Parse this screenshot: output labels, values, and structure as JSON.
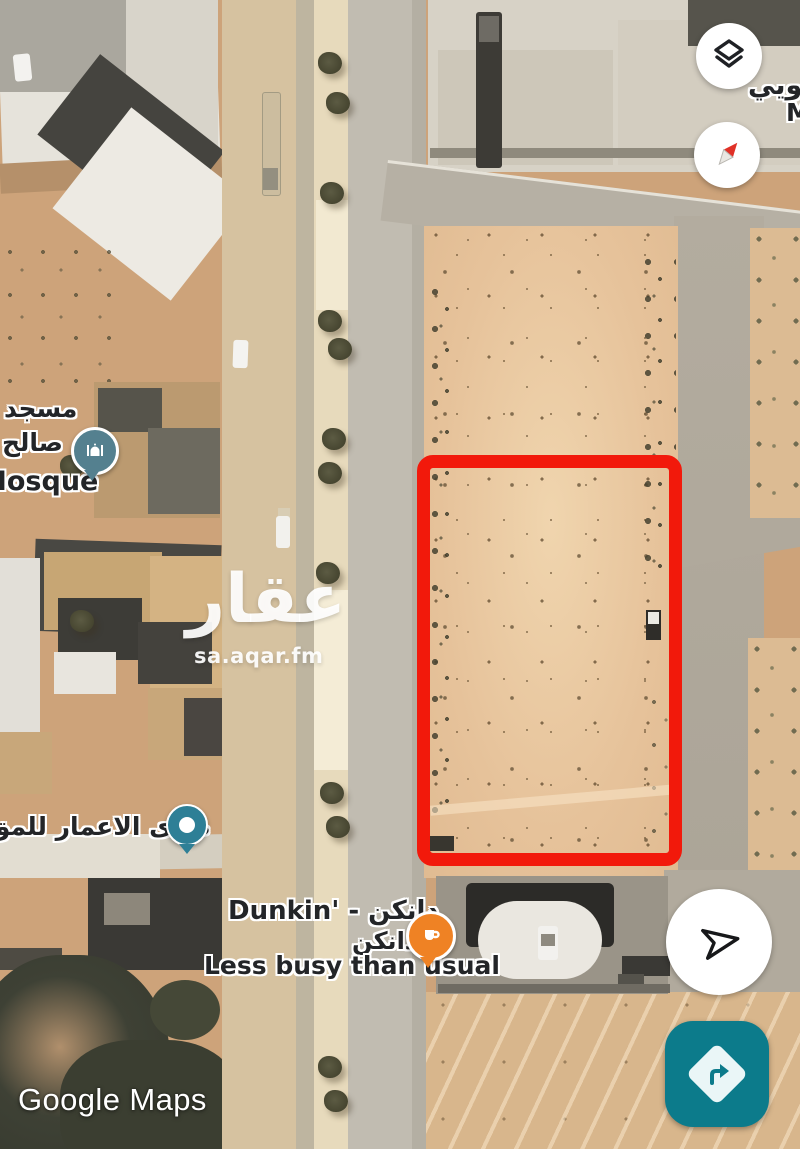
{
  "attribution": {
    "text": "Google Maps"
  },
  "watermark": {
    "logo": "عقار",
    "site": "sa.aqar.fm"
  },
  "labels": {
    "district": {
      "name": "لحويي",
      "partial": "M"
    },
    "mosque": {
      "line1": "مسجد",
      "line2": "صالح",
      "line3": "Mosque"
    },
    "contractor": {
      "text": "صدى الاعمار للمق"
    },
    "dunkin": {
      "title": "Dunkin' - دانكن",
      "subtitle": "دانكن",
      "status": "Less busy than usual"
    }
  },
  "markers": {
    "mosque": {
      "icon": "mosque-icon",
      "color": "#54808f"
    },
    "contractor": {
      "icon": "place-dot-icon",
      "color": "#2e7f96"
    },
    "dunkin": {
      "icon": "coffee-cup-icon",
      "color": "#ef8224"
    }
  },
  "plot_outline": {
    "shape": "rectangle",
    "color": "#f2190b"
  },
  "controls": {
    "layers": {
      "icon": "layers-icon"
    },
    "compass": {
      "icon": "compass-icon",
      "needle_color": "#e03127"
    },
    "my_location": {
      "icon": "navigation-arrow-icon"
    },
    "directions": {
      "icon": "turn-right-icon",
      "color": "#0c7b8b"
    }
  }
}
